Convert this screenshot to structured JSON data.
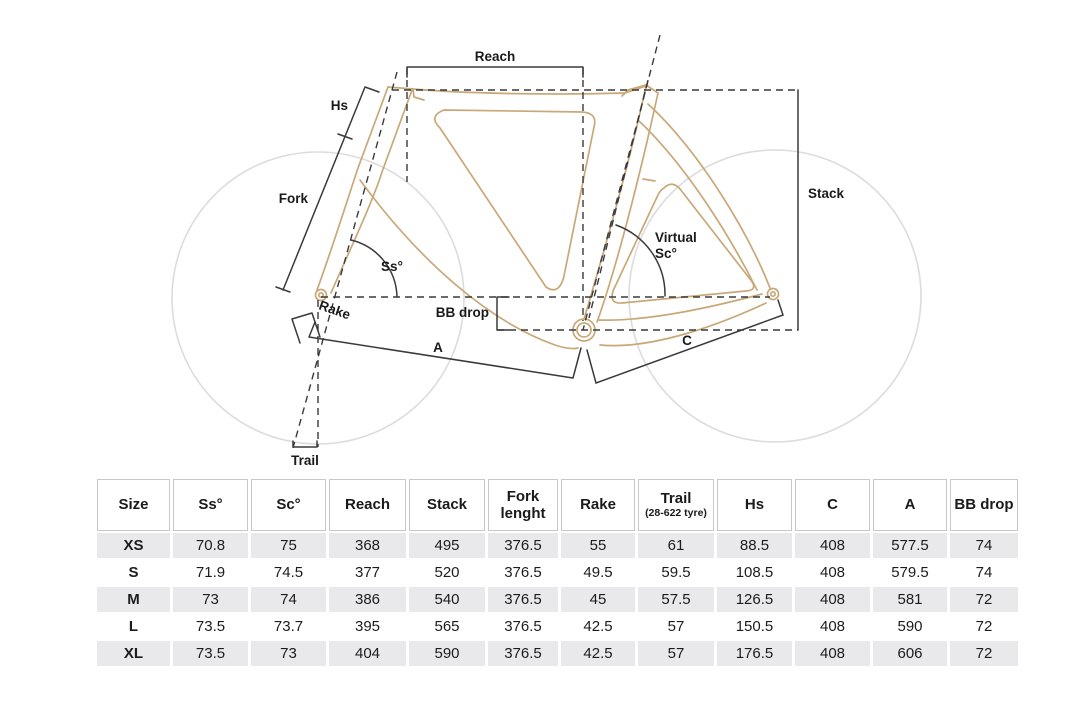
{
  "diagram": {
    "labels": {
      "reach": "Reach",
      "hs": "Hs",
      "fork": "Fork",
      "stack": "Stack",
      "ss": "Ss°",
      "virtual_line1": "Virtual",
      "virtual_line2": "Sc°",
      "rake": "Rake",
      "bb_drop": "BB drop",
      "a": "A",
      "c": "C",
      "trail": "Trail"
    },
    "colors": {
      "frame": "#C9A878",
      "wheel": "#DCDCDC",
      "dimension_lines": "#3A3A3A",
      "label_text": "#1A1A1A"
    }
  },
  "table": {
    "columns": [
      "Size",
      "Ss°",
      "Sc°",
      "Reach",
      "Stack",
      "Fork lenght",
      "Rake",
      "Trail",
      "Hs",
      "C",
      "A",
      "BB drop"
    ],
    "trail_subnote": "(28-622 tyre)",
    "row_shade_color": "#E9E9EB",
    "rows": [
      [
        "XS",
        "70.8",
        "75",
        "368",
        "495",
        "376.5",
        "55",
        "61",
        "88.5",
        "408",
        "577.5",
        "74"
      ],
      [
        "S",
        "71.9",
        "74.5",
        "377",
        "520",
        "376.5",
        "49.5",
        "59.5",
        "108.5",
        "408",
        "579.5",
        "74"
      ],
      [
        "M",
        "73",
        "74",
        "386",
        "540",
        "376.5",
        "45",
        "57.5",
        "126.5",
        "408",
        "581",
        "72"
      ],
      [
        "L",
        "73.5",
        "73.7",
        "395",
        "565",
        "376.5",
        "42.5",
        "57",
        "150.5",
        "408",
        "590",
        "72"
      ],
      [
        "XL",
        "73.5",
        "73",
        "404",
        "590",
        "376.5",
        "42.5",
        "57",
        "176.5",
        "408",
        "606",
        "72"
      ]
    ]
  }
}
